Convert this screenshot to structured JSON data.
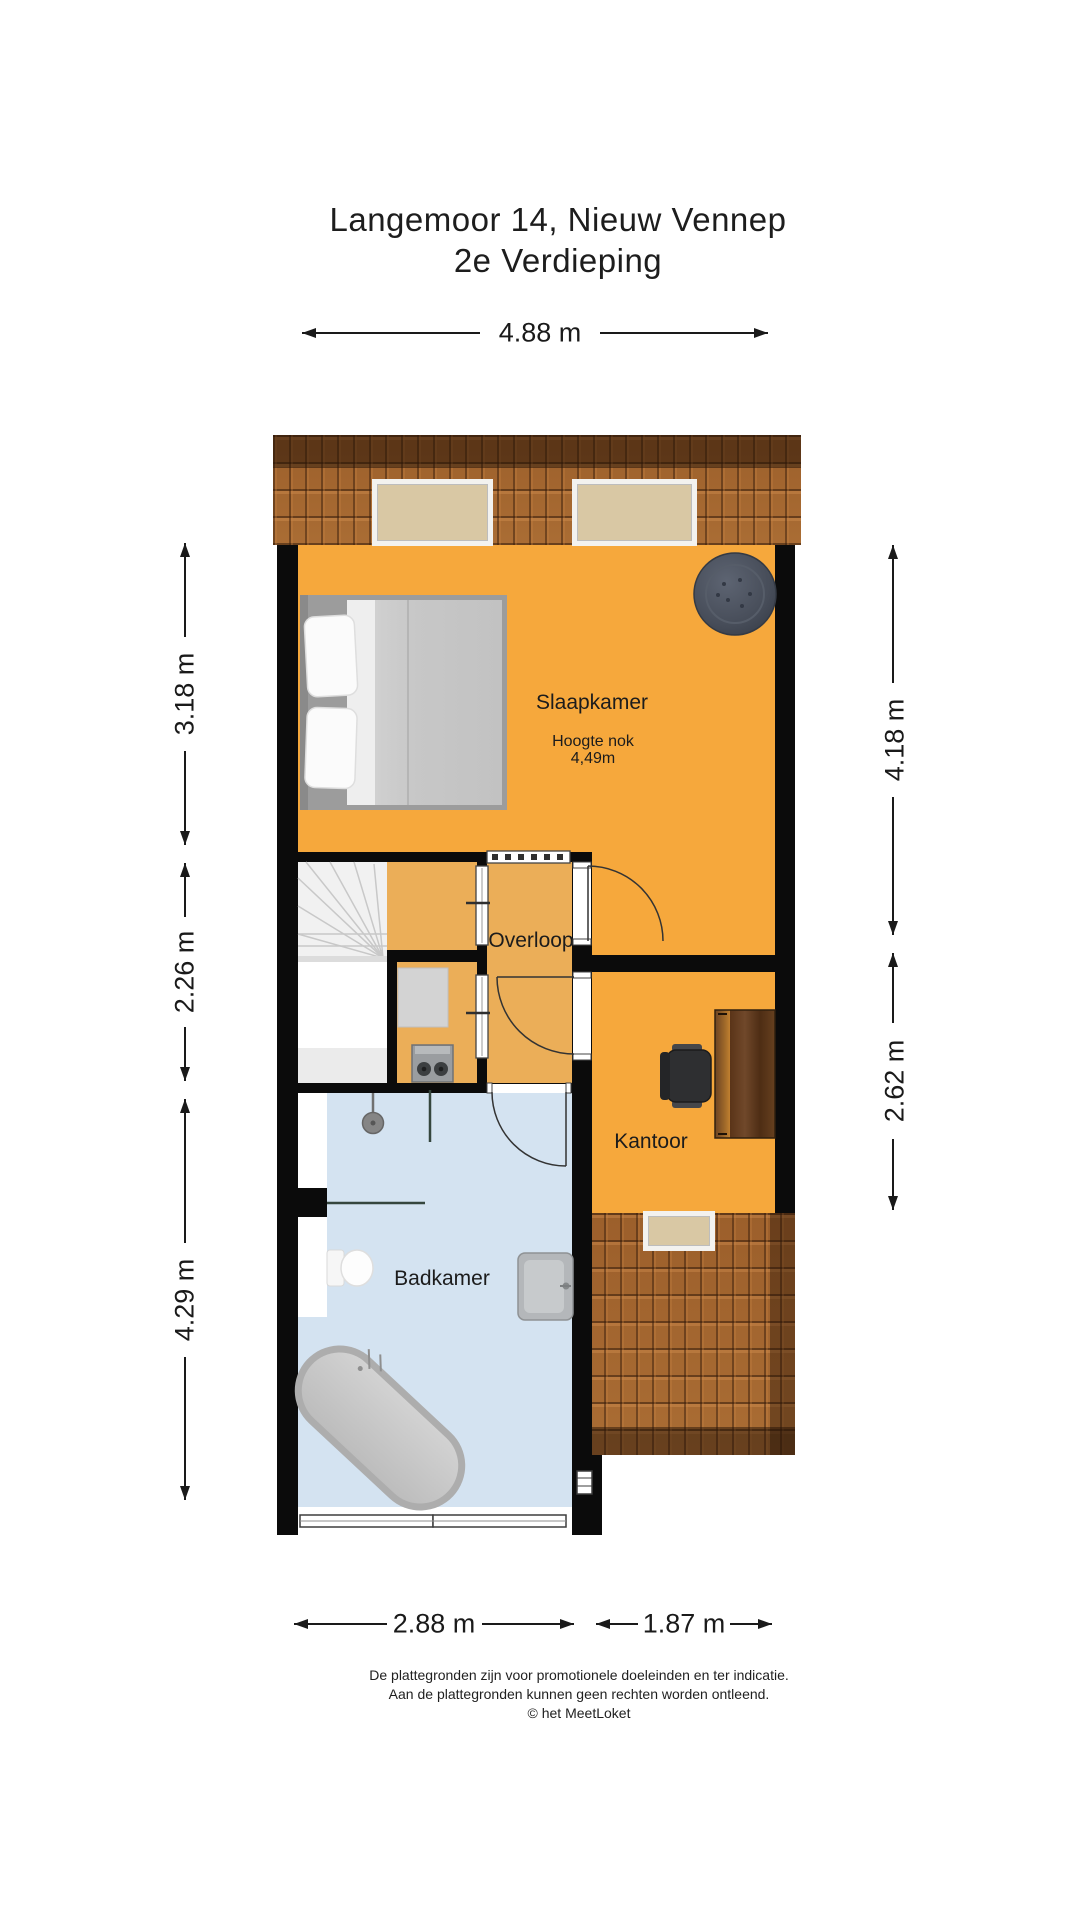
{
  "title": {
    "line1": "Langemoor 14, Nieuw Vennep",
    "line2": "2e Verdieping"
  },
  "dimensions": {
    "top": "4.88 m",
    "left_upper": "3.18 m",
    "left_middle": "2.26 m",
    "left_lower": "4.29 m",
    "right_upper": "4.18 m",
    "right_lower": "2.62 m",
    "bottom_left": "2.88 m",
    "bottom_right": "1.87 m"
  },
  "rooms": {
    "slaapkamer": {
      "label": "Slaapkamer",
      "note_line1": "Hoogte nok",
      "note_line2": "4,49m"
    },
    "overloop": {
      "label": "Overloop"
    },
    "kantoor": {
      "label": "Kantoor"
    },
    "badkamer": {
      "label": "Badkamer"
    }
  },
  "footer": {
    "line1": "De plattegronden zijn voor promotionele doeleinden en ter indicatie.",
    "line2": "Aan de plattegronden kunnen geen rechten worden ontleend.",
    "line3": "© het MeetLoket"
  },
  "colors": {
    "floor_orange": "#F6A83C",
    "floor_orange_soft": "#EBAE58",
    "floor_blue": "#D4E3F1",
    "wall_black": "#0B0B0B",
    "roof_brown": "#A4662F",
    "roof_dark_band": "#5E3B1E",
    "skylight_beige": "#D9C8A4"
  }
}
